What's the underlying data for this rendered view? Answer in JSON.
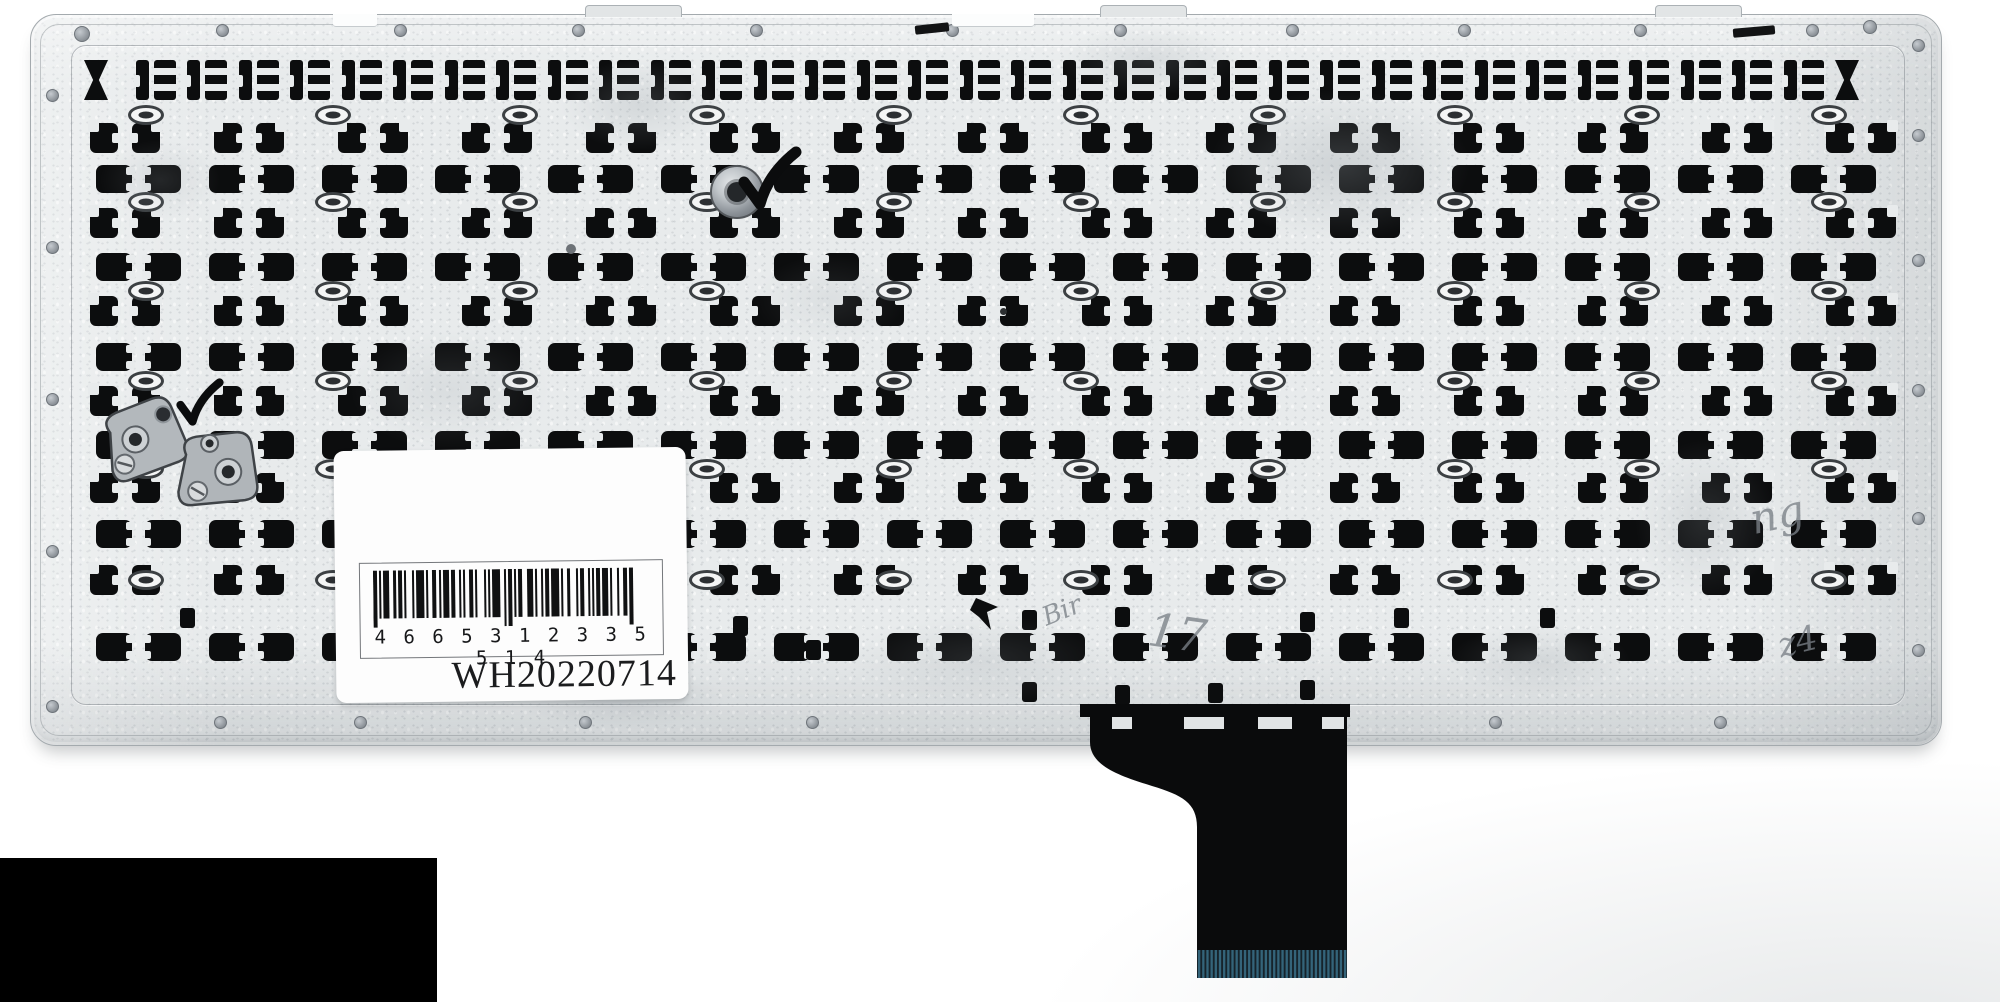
{
  "photo": {
    "subject": "laptop keyboard metal backplate, rear view",
    "colors": {
      "background": "#ffffff",
      "plate": "#e8ebec",
      "clip_cutout": "#0c0d0e",
      "label_bg": "#fdfdfd",
      "cable": "#0a0b0c",
      "cable_pins": "#34647a",
      "metal_bracket": "#b3b8bc",
      "censor_box": "#000000"
    }
  },
  "label": {
    "barcode_digits": "4 6 6 5 3 1 2 3 3 5 5 1 4",
    "code": "WH20220714",
    "bars": [
      2,
      1,
      1,
      1,
      3,
      2,
      1,
      1,
      2,
      1,
      1,
      3,
      1,
      1,
      4,
      1,
      1,
      2,
      2,
      1,
      1,
      1,
      3,
      1,
      2,
      2,
      1,
      1,
      1,
      2,
      2,
      1,
      1,
      3,
      1,
      1,
      1,
      1,
      4,
      2,
      1,
      1,
      2,
      1,
      1,
      1,
      2,
      2,
      3,
      1,
      1,
      2,
      1,
      1,
      2,
      1,
      4,
      1,
      1,
      2,
      1,
      3,
      1,
      1,
      2,
      2,
      1,
      1,
      1,
      1,
      2,
      1,
      3,
      1,
      1,
      2,
      1,
      2,
      2,
      1,
      2
    ]
  },
  "plate": {
    "clip_rows": [
      {
        "type": "bracket",
        "y": 60,
        "x0": 84,
        "pitch": 51.5,
        "n": 35
      },
      {
        "type": "hook",
        "y": 123,
        "x0": 90,
        "pitch": 124,
        "n": 15
      },
      {
        "type": "square",
        "y": 165,
        "x0": 96,
        "pitch": 113,
        "n": 16
      },
      {
        "type": "hook",
        "y": 208,
        "x0": 90,
        "pitch": 124,
        "n": 15
      },
      {
        "type": "square",
        "y": 253,
        "x0": 96,
        "pitch": 113,
        "n": 16
      },
      {
        "type": "hook",
        "y": 296,
        "x0": 90,
        "pitch": 124,
        "n": 15
      },
      {
        "type": "square",
        "y": 343,
        "x0": 96,
        "pitch": 113,
        "n": 16
      },
      {
        "type": "hook",
        "y": 386,
        "x0": 90,
        "pitch": 124,
        "n": 15
      },
      {
        "type": "square",
        "y": 431,
        "x0": 96,
        "pitch": 113,
        "n": 16
      },
      {
        "type": "hook",
        "y": 473,
        "x0": 90,
        "pitch": 124,
        "n": 15
      },
      {
        "type": "square",
        "y": 520,
        "x0": 96,
        "pitch": 113,
        "n": 16
      },
      {
        "type": "hook",
        "y": 565,
        "x0": 90,
        "pitch": 124,
        "n": 15
      },
      {
        "type": "square",
        "y": 633,
        "x0": 96,
        "pitch": 113,
        "n": 16
      }
    ],
    "bits": [
      [
        180,
        608
      ],
      [
        420,
        606
      ],
      [
        733,
        616
      ],
      [
        806,
        640
      ],
      [
        1022,
        610
      ],
      [
        1115,
        607
      ],
      [
        1300,
        612
      ],
      [
        1394,
        608
      ],
      [
        1022,
        682
      ],
      [
        1115,
        685
      ],
      [
        1208,
        683
      ],
      [
        1300,
        680
      ],
      [
        1540,
        608
      ]
    ],
    "eyelets": {
      "ys": [
        105,
        192,
        281,
        371,
        459,
        570
      ],
      "x0": 128,
      "pitch": 187,
      "n": 10
    },
    "rivets": {
      "top_y": 30,
      "top_x": [
        222,
        400,
        578,
        756,
        952,
        1120,
        1292,
        1464,
        1640,
        1812
      ],
      "left_x": 52,
      "left_y": [
        95,
        247,
        399,
        551,
        706
      ],
      "right_x": 1918,
      "right_y": [
        45,
        135,
        260,
        390,
        518,
        650
      ],
      "bottom_y": 722,
      "bottom_x": [
        220,
        360,
        585,
        812,
        1495,
        1720
      ],
      "extra": [
        [
          82,
          34,
          16
        ],
        [
          1870,
          27,
          14
        ]
      ]
    },
    "smudges": [
      [
        1340,
        165,
        260,
        150,
        0.5
      ],
      [
        640,
        105,
        160,
        90,
        0.4
      ],
      [
        1150,
        60,
        180,
        70,
        0.35
      ],
      [
        450,
        390,
        200,
        120,
        0.3
      ],
      [
        620,
        698,
        210,
        62,
        0.45
      ],
      [
        1705,
        520,
        140,
        160,
        0.35
      ],
      [
        980,
        660,
        260,
        90,
        0.3
      ],
      [
        160,
        180,
        120,
        80,
        0.3
      ],
      [
        1540,
        660,
        180,
        70,
        0.35
      ],
      [
        830,
        300,
        150,
        90,
        0.25
      ]
    ],
    "tabs": [
      [
        585,
        95
      ],
      [
        1100,
        85
      ],
      [
        1655,
        85
      ]
    ],
    "notches": [
      [
        333,
        44
      ],
      [
        952,
        82
      ]
    ],
    "streaks": [
      [
        915,
        24,
        34,
        9,
        -6
      ],
      [
        1733,
        27,
        42,
        9,
        -5
      ]
    ],
    "dots": [
      [
        566,
        244,
        10,
        "#6d7277"
      ],
      [
        1000,
        308,
        7,
        "#2c2f31"
      ]
    ],
    "checkmarks": [
      [
        738,
        146,
        1.0
      ],
      [
        176,
        378,
        0.75
      ]
    ],
    "annotations": [
      {
        "text": "Bir",
        "x": 1042,
        "y": 596,
        "rot": -22,
        "size": 26
      },
      {
        "text": "17",
        "x": 1148,
        "y": 606,
        "rot": 8,
        "size": 46
      },
      {
        "text": "ng",
        "x": 1750,
        "y": 490,
        "rot": -12,
        "size": 42
      },
      {
        "text": "z4",
        "x": 1778,
        "y": 622,
        "rot": -14,
        "size": 34
      }
    ]
  },
  "cable": {
    "pin_count": 36
  }
}
